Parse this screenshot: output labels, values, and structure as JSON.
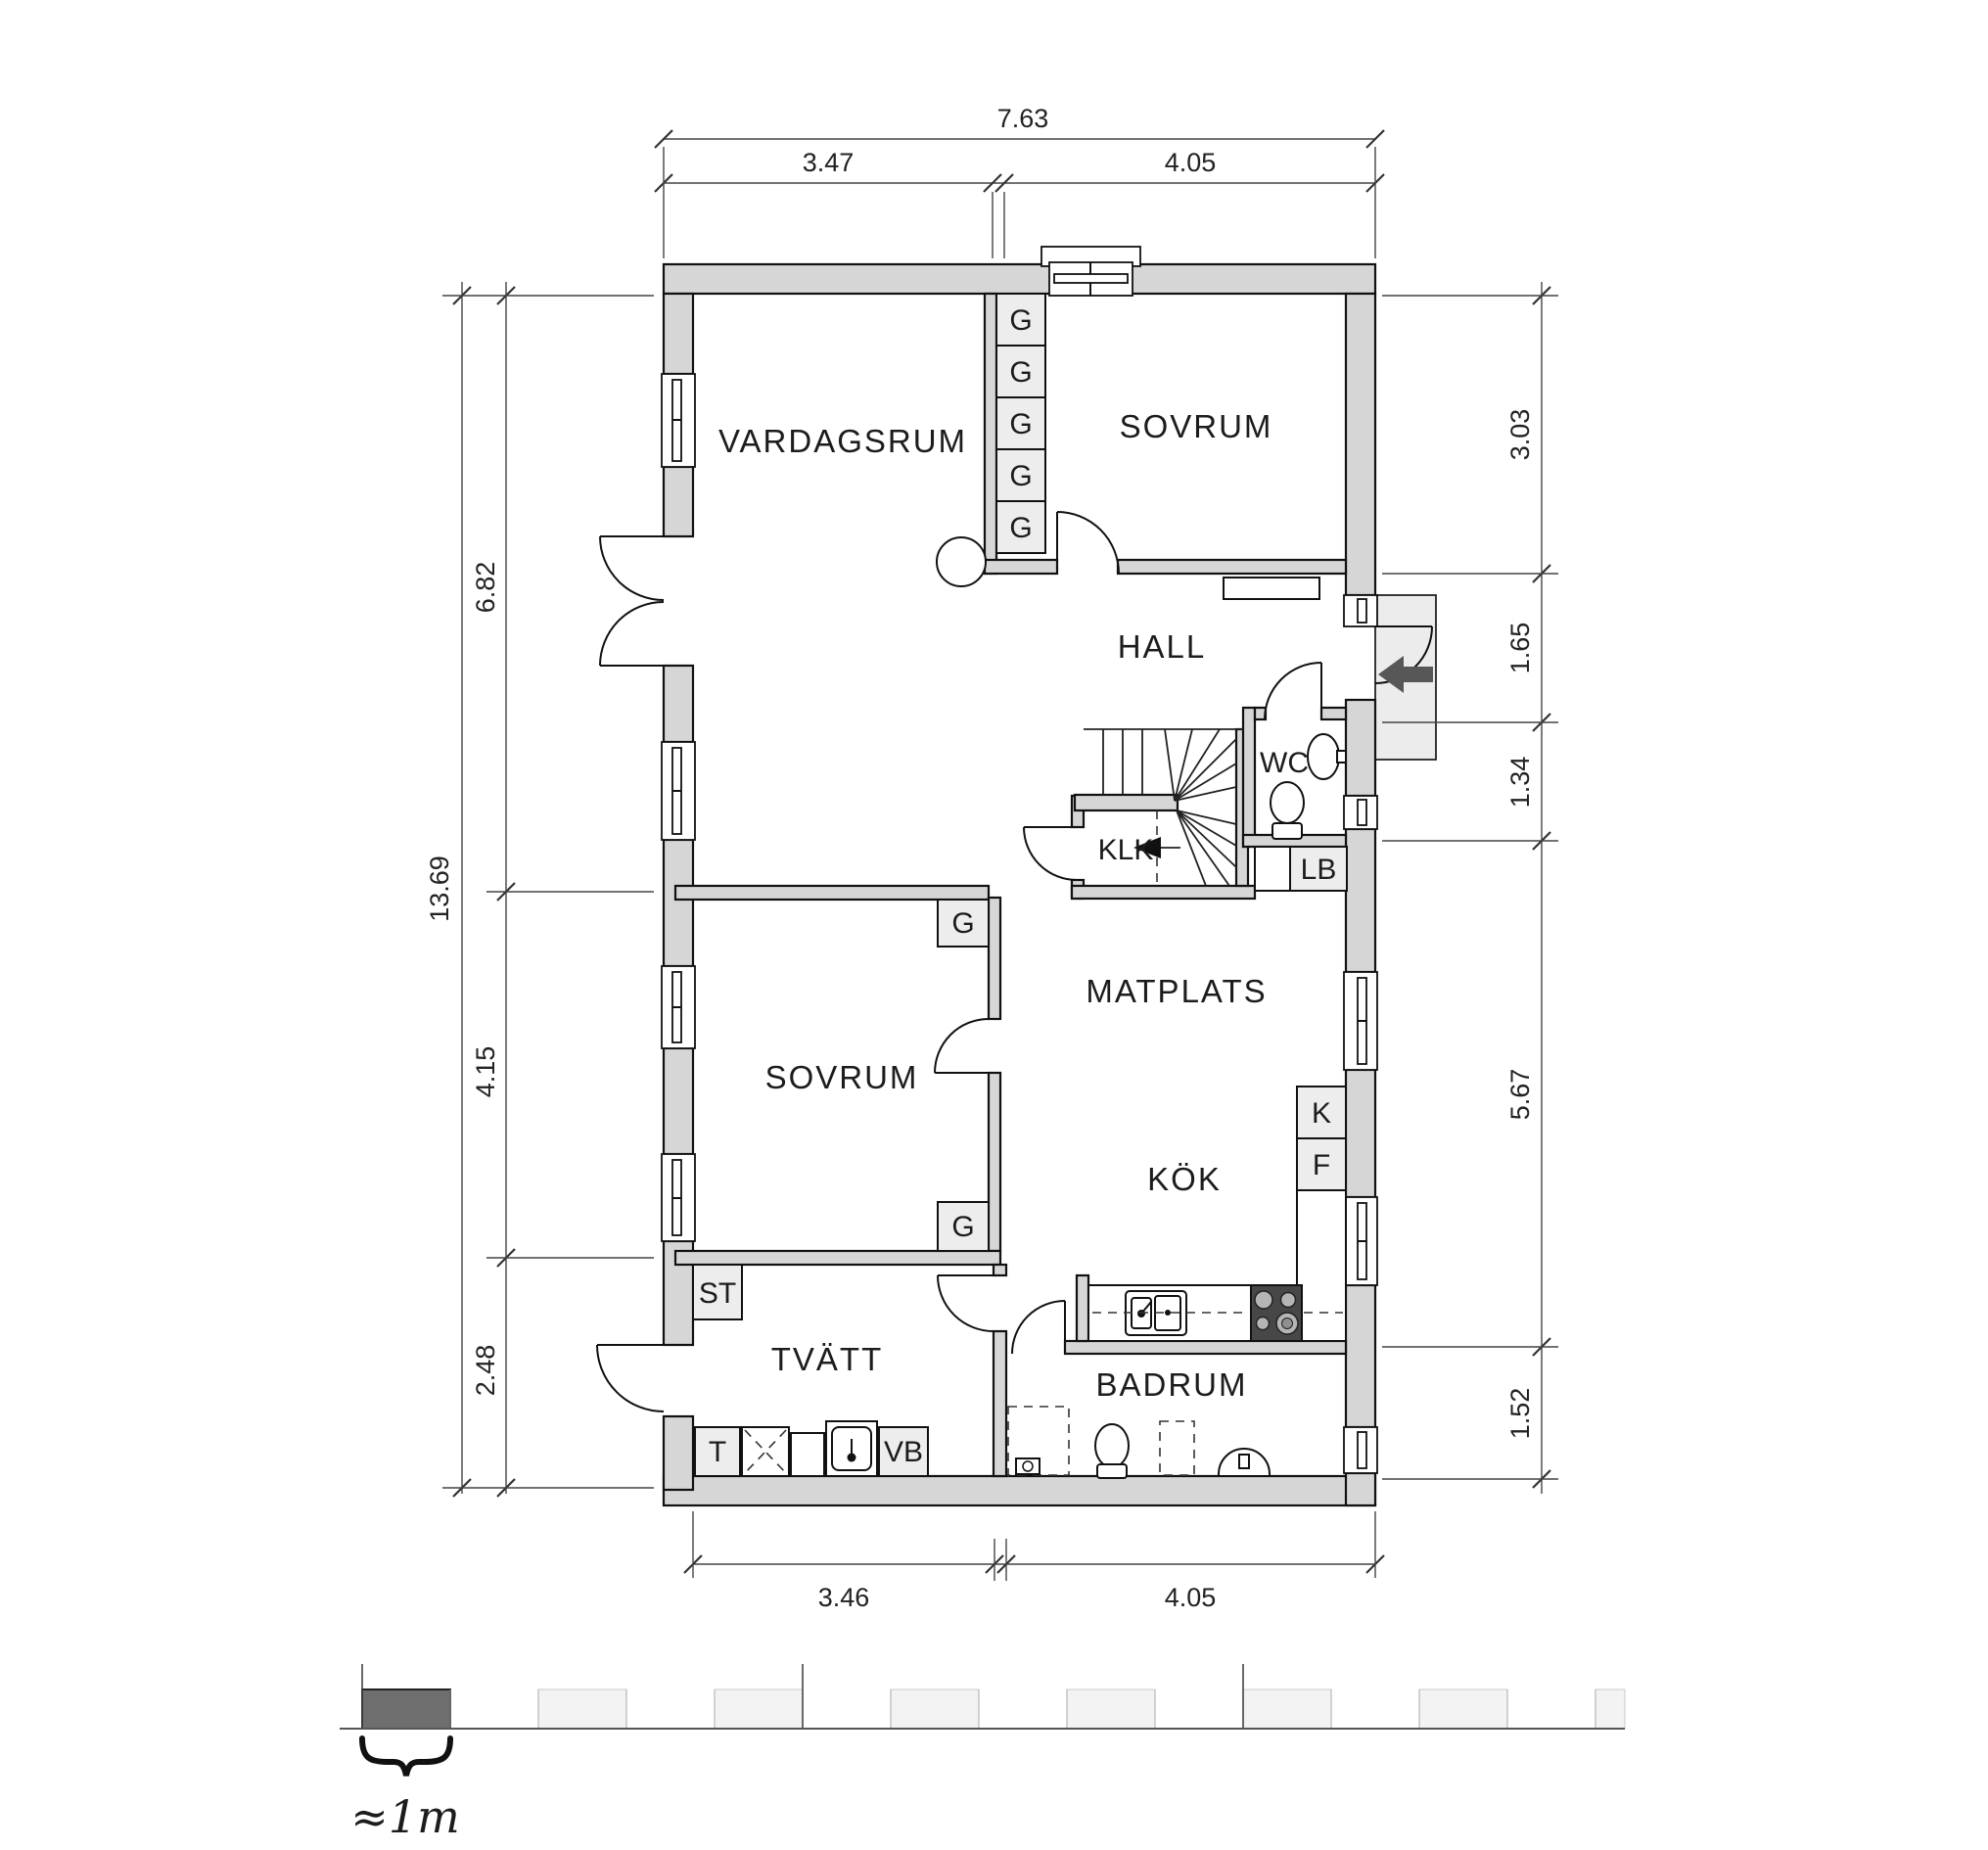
{
  "floor_plan": {
    "rooms": {
      "vardagsrum": "VARDAGSRUM",
      "sovrum_top": "SOVRUM",
      "hall": "HALL",
      "wc": "WC",
      "klk": "KLK",
      "matplats": "MATPLATS",
      "kok": "KÖK",
      "sovrum_bottom": "SOVRUM",
      "tvatt": "TVÄTT",
      "badrum": "BADRUM"
    },
    "storage_labels": {
      "g": "G",
      "st": "ST",
      "lb": "LB",
      "k": "K",
      "f": "F",
      "t": "T",
      "vb": "VB"
    },
    "dimensions": {
      "top": {
        "overall": "7.63",
        "segments": [
          "3.47",
          "4.05"
        ]
      },
      "bottom": {
        "segments": [
          "3.46",
          "4.05"
        ]
      },
      "left": {
        "overall": "13.69",
        "segments": [
          "6.82",
          "4.15",
          "2.48"
        ]
      },
      "right": {
        "segments": [
          "3.03",
          "1.65",
          "1.34",
          "5.67",
          "1.52"
        ]
      }
    },
    "scale_bar": {
      "label": "≈1m"
    },
    "colors": {
      "wall_fill": "#d6d6d6",
      "closet_fill": "#ededed",
      "stove_fill": "#474747",
      "entry_arrow_fill": "#575757",
      "scale_dark": "#6e6e6e",
      "scale_light": "#f3f3f3",
      "line": "#111111"
    }
  }
}
